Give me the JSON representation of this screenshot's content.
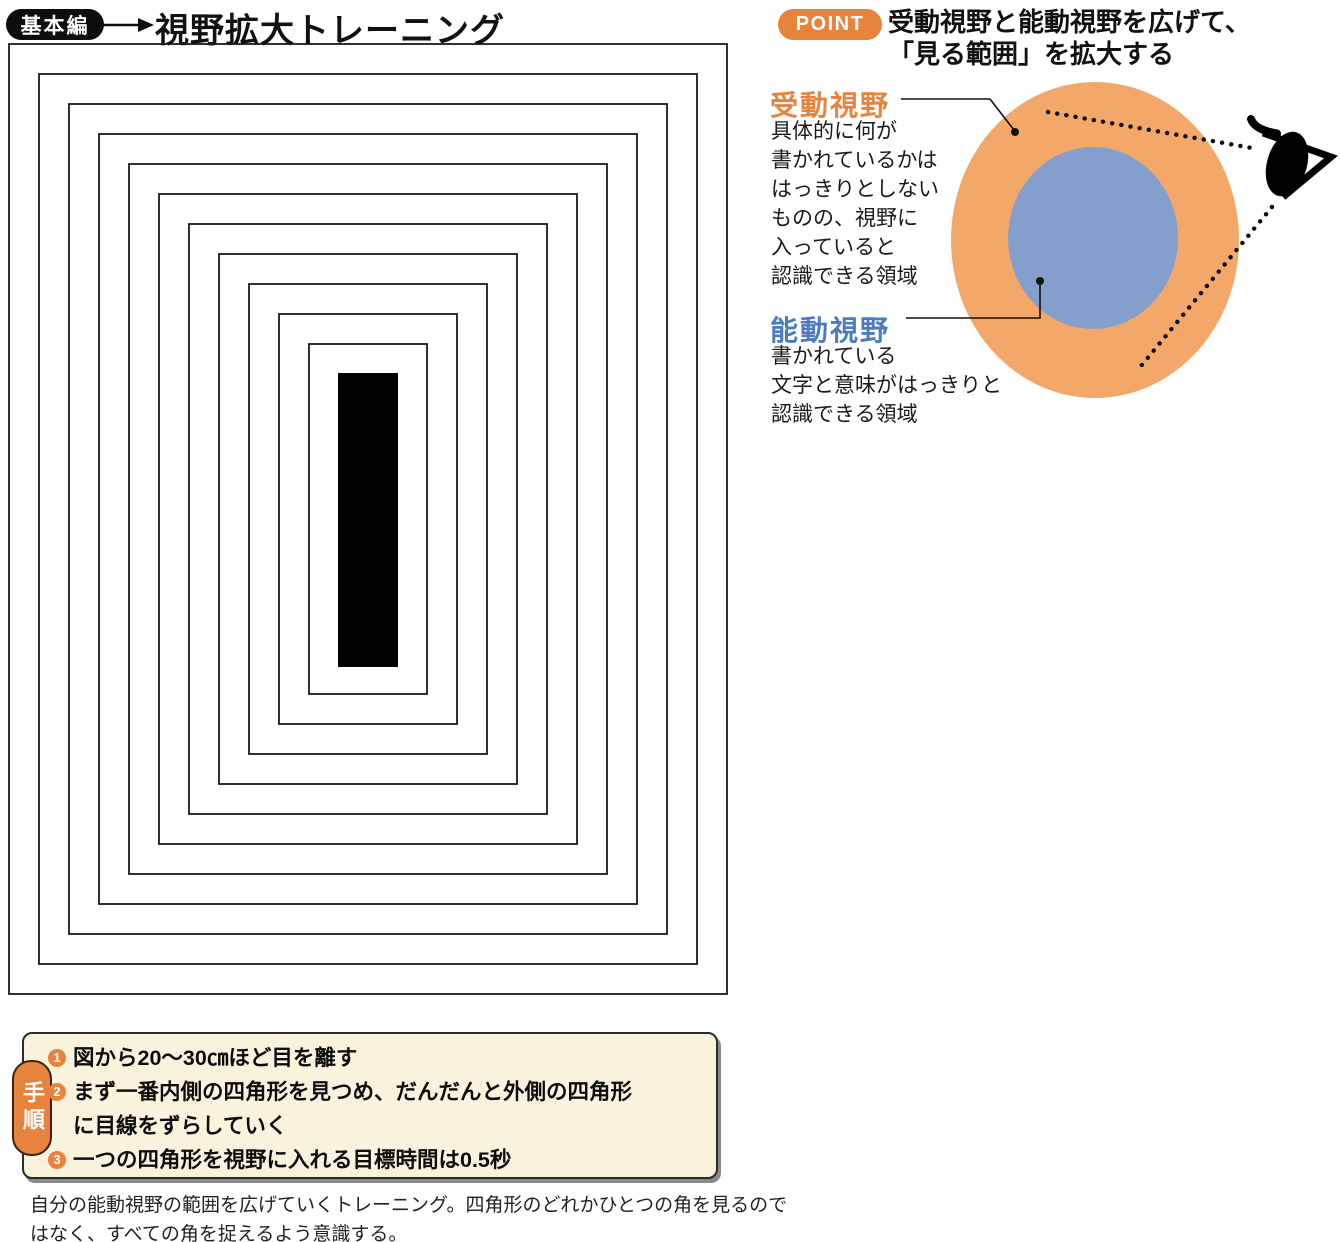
{
  "header": {
    "badge": "基本編",
    "title": "視野拡大トレーニング"
  },
  "point": {
    "badge": "POINT",
    "title_lines": [
      "受動視野と能動視野を広げて、",
      "「見る範囲」を拡大する"
    ]
  },
  "passive_vision": {
    "label": "受動視野",
    "description_lines": [
      "具体的に何が",
      "書かれているかは",
      "はっきりとしない",
      "ものの、視野に",
      "入っていると",
      "認識できる領域"
    ]
  },
  "active_vision": {
    "label": "能動視野",
    "description_lines": [
      "書かれている",
      "文字と意味がはっきりと",
      "認識できる領域"
    ]
  },
  "steps": {
    "label": "手順",
    "items": [
      {
        "num": "1",
        "lines": [
          "図から20～30㎝ほど目を離す"
        ]
      },
      {
        "num": "2",
        "lines": [
          "まず一番内側の四角形を見つめ、だんだんと外側の四角形",
          "に目線をずらしていく"
        ]
      },
      {
        "num": "3",
        "lines": [
          "一つの四角形を視野に入れる目標時間は0.5秒"
        ]
      }
    ]
  },
  "caption_lines": [
    "自分の能動視野の範囲を広げていくトレーニング。四角形のどれかひとつの角を見るので",
    "はなく、すべての角を捉えるよう意識する。"
  ],
  "rect_diagram": {
    "count": 11,
    "inset_step": 30,
    "outer": {
      "x": 1,
      "y": 1,
      "width": 718,
      "height": 950
    },
    "stroke": "#1a1a1a",
    "stroke_width": 1.8,
    "center_bar": {
      "x": 330,
      "y": 330,
      "width": 60,
      "height": 294,
      "fill": "#000000"
    }
  },
  "colors": {
    "accent_orange": "#e8833c",
    "circle_orange": "#f3a869",
    "circle_blue": "#859fcd",
    "label_blue": "#4d7cbe",
    "steps_bg": "#f9f3de"
  }
}
